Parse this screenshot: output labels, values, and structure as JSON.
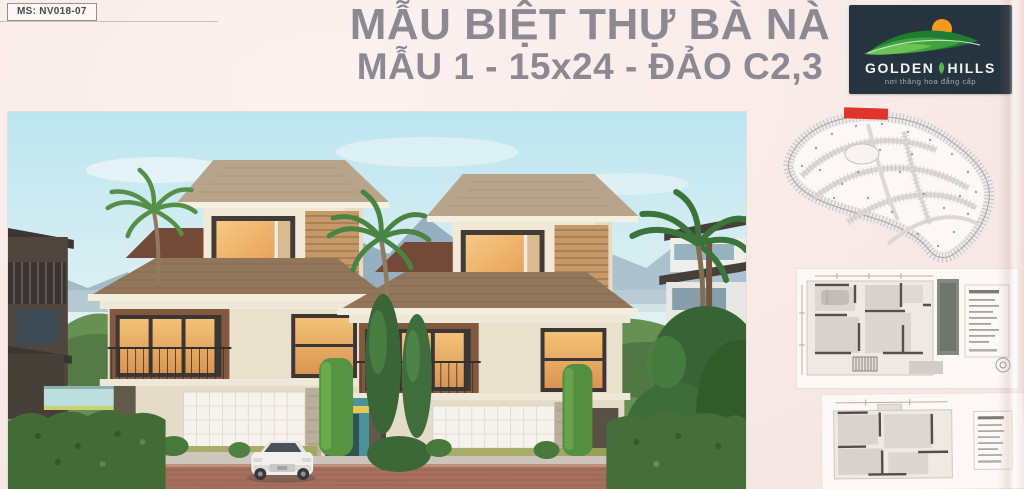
{
  "poster": {
    "ms_code": "MS: NV018-07",
    "title_line1": "MẪU BIỆT THỰ BÀ NÀ",
    "title_line2": "MẪU 1 - 15x24 - ĐẢO C2,3",
    "title_color": "#8d8992",
    "background_color": "#f7e9e6"
  },
  "logo": {
    "word1": "GOLDEN",
    "word2": "HILLS",
    "tagline": "nơi thăng hoa đẳng cấp",
    "bg_color": "#26343f",
    "sun_color": "#f6991d",
    "hill_colors": [
      "#1e7c33",
      "#3fa23c",
      "#6cc253"
    ]
  },
  "master_plan": {
    "highlight_color": "#e0332a",
    "outline_color": "#a8a4ab"
  },
  "rendering": {
    "sky_color": "#bfe7f1",
    "mountain_color": "#8aa6ba",
    "roof_color": "#8a6e50",
    "wall_color": "#f2e9d6",
    "wood_color": "#7a4f33",
    "hedge_color": "#36622c",
    "road_color": "#a26753",
    "car_color": "#f2f2ef"
  }
}
